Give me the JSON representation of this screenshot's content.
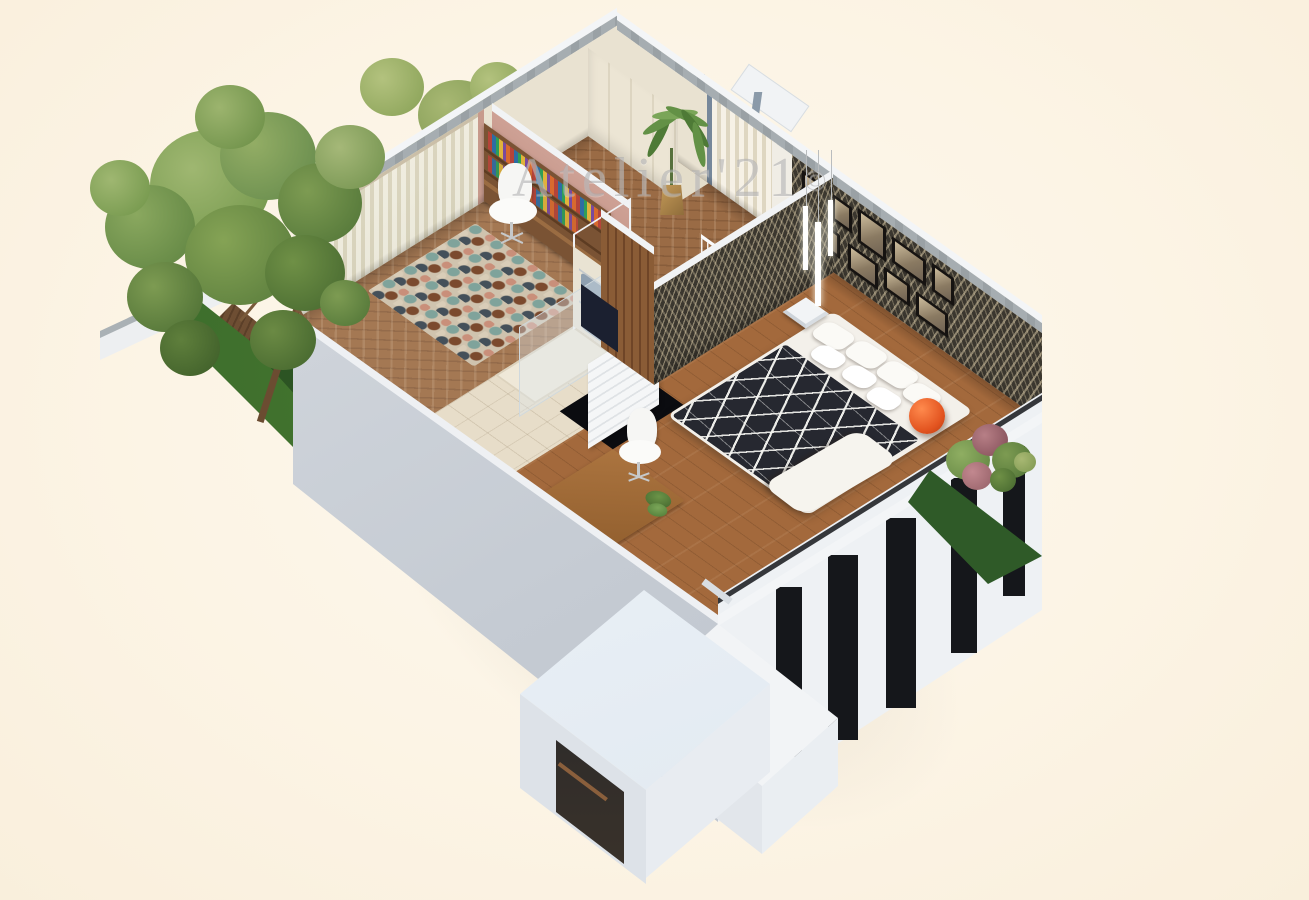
{
  "image": {
    "kind": "3d-floorplan-cutaway-render",
    "view": "isometric dollhouse view of an upper storey interior with garden trees"
  },
  "watermark": {
    "text": "Atelier'21",
    "symbol": "©"
  },
  "palette": {
    "background": "#fcf4e5",
    "wall_white": "#eef1f4",
    "wall_gray_face": "#c9cfd7",
    "cut_concrete": "#a6adb1",
    "wood_floor": "#9a6b45",
    "wood_dark": "#7a5334",
    "bathroom_tile": "#e7ddc9",
    "wardrobe_cream": "#ece5d4",
    "curtain": "#f6f1e6",
    "accent_wall": "#3b372f",
    "pink_wall": "#c79a8c",
    "duvet": "#262830",
    "accent_orange": "#e8622c",
    "grass": "#3a6a2d",
    "tree_green": "#6f9a4f",
    "pot_gold": "#b08d4f",
    "window_glass": "#15171b",
    "blue_gray_frame": "#7e8fa0"
  },
  "scene": {
    "rooms": [
      {
        "name": "dressing-room",
        "objects": [
          "built-in-wardrobe",
          "window-curtains",
          "palm-plant",
          "herringbone-floor"
        ]
      },
      {
        "name": "home-office",
        "objects": [
          "curtained-window",
          "bookshelf-desk",
          "office-chair",
          "mosaic-rug"
        ]
      },
      {
        "name": "bathroom",
        "objects": [
          "shower-glass",
          "towel-rack",
          "towels",
          "radiator",
          "wood-door",
          "tile-floor"
        ]
      },
      {
        "name": "hallway",
        "objects": [
          "staircase",
          "cable-railing",
          "dark-chest",
          "stairwell-void",
          "wood-slat-wall"
        ]
      },
      {
        "name": "master-bedroom",
        "objects": [
          "double-bed",
          "patterned-duvet",
          "pillows",
          "orange-ball",
          "cube-stool",
          "gallery-frames",
          "pendant-lights",
          "desk",
          "chair",
          "desk-plant",
          "accent-wallpaper"
        ]
      }
    ],
    "exterior": [
      "left-garden-trees",
      "lawn-strips",
      "wood-fence",
      "right-flower-bushes",
      "white-extension-box",
      "facade-window-slits"
    ],
    "counts": {
      "gallery_frames": 9,
      "pillows": 7,
      "pendant_lights": 3,
      "stair_steps": 7,
      "facade_window_slits": 5
    }
  }
}
